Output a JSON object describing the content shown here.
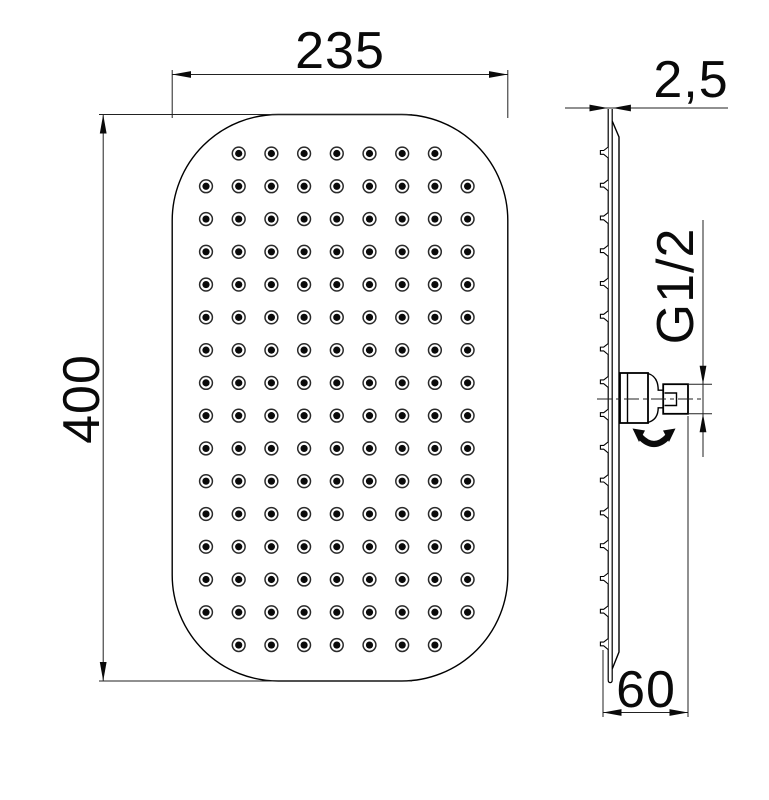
{
  "document": {
    "type": "technical drawing",
    "subject": "rectangular rain shower head, front and side orthographic views"
  },
  "dimensions": {
    "width_mm": "235",
    "height_mm": "400",
    "thickness_mm": "2,5",
    "thread_size": "G1/2",
    "depth_mm": "60"
  },
  "front_view": {
    "nozzle_grid": {
      "rows": 16,
      "cols": 9,
      "x0": 206,
      "y0": 153.5,
      "dx": 32.7,
      "dy": 32.77,
      "first_last_row_cols": 7,
      "outer_radius": 6.4,
      "inner_radius": 3.6
    }
  },
  "side_view": {
    "teeth": {
      "count": 16,
      "x": 608.2,
      "y0": 153.5,
      "dy": 32.77
    }
  },
  "colors": {
    "object_line": "#000000",
    "dim_line": "#222222",
    "nozzle_fill": "#0a0a0a"
  }
}
